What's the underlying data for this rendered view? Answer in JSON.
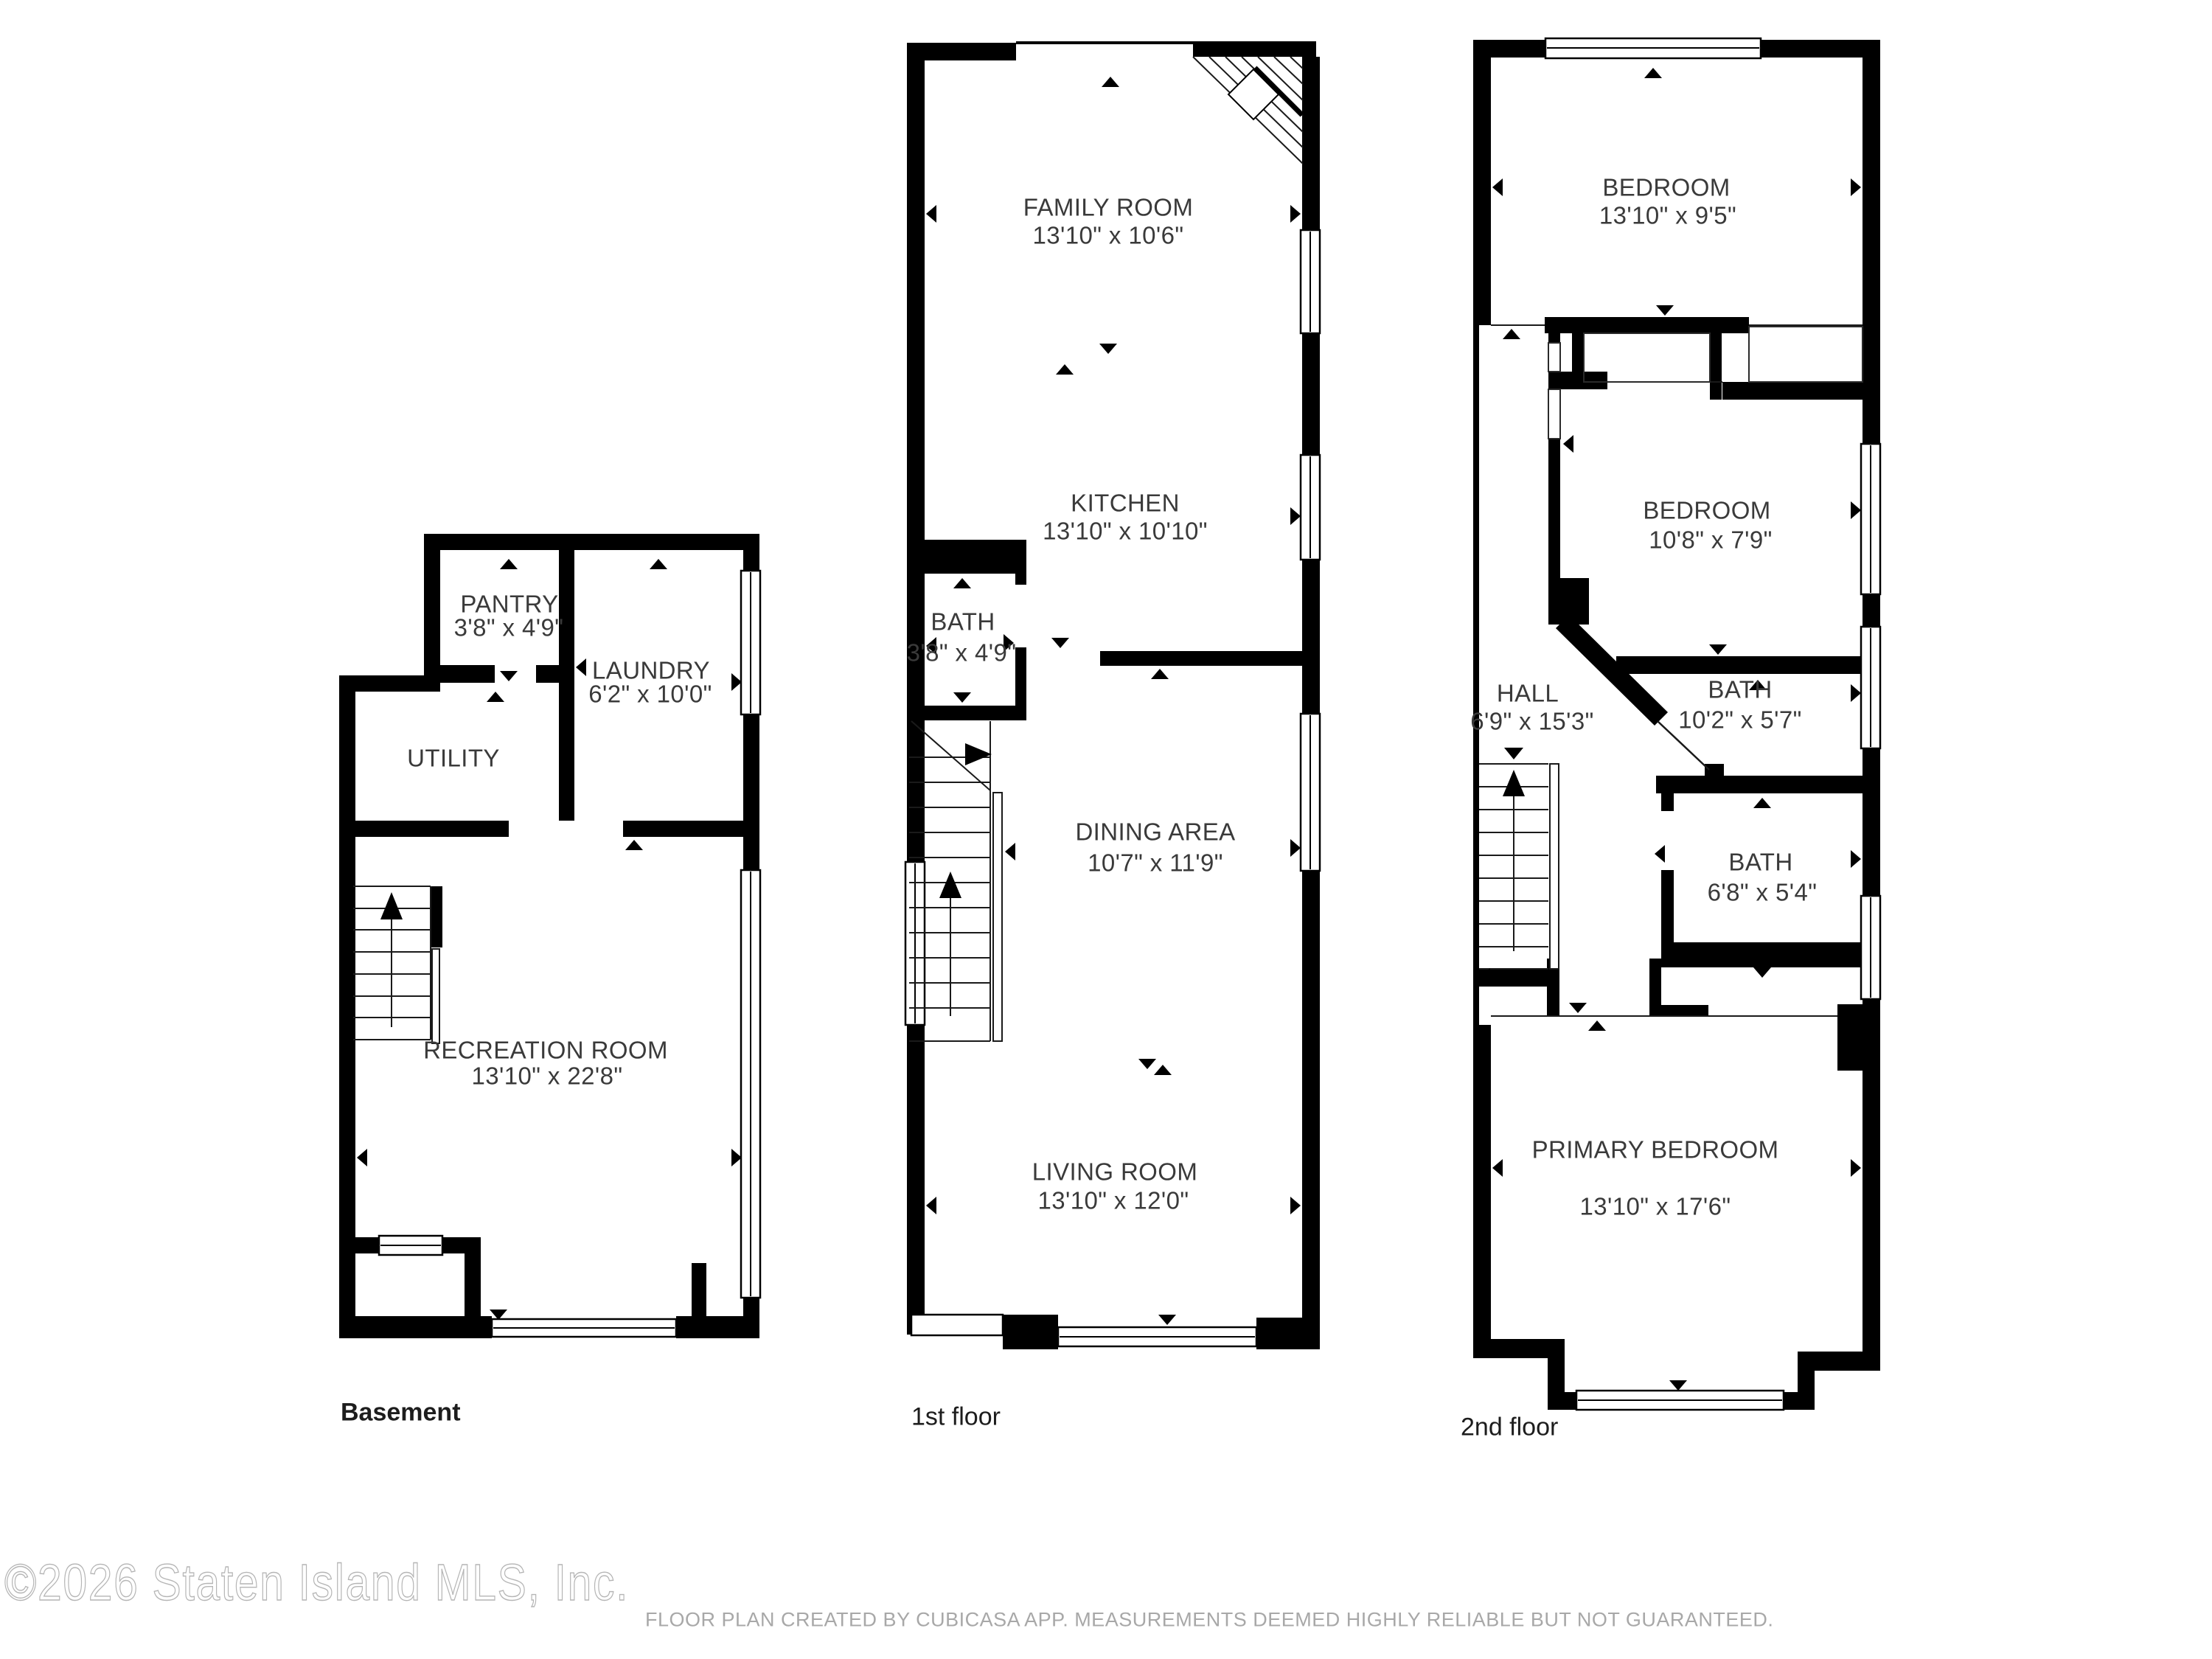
{
  "floors": [
    {
      "title": "Basement",
      "rooms": [
        {
          "name": "PANTRY",
          "dims": "3'8\" x 4'9\""
        },
        {
          "name": "LAUNDRY",
          "dims": "6'2\" x 10'0\""
        },
        {
          "name": "UTILITY",
          "dims": ""
        },
        {
          "name": "RECREATION ROOM",
          "dims": "13'10\" x 22'8\""
        }
      ]
    },
    {
      "title": "1st floor",
      "rooms": [
        {
          "name": "FAMILY ROOM",
          "dims": "13'10\" x 10'6\""
        },
        {
          "name": "KITCHEN",
          "dims": "13'10\" x 10'10\""
        },
        {
          "name": "BATH",
          "dims": "3'8\" x 4'9\""
        },
        {
          "name": "DINING AREA",
          "dims": "10'7\" x 11'9\""
        },
        {
          "name": "LIVING ROOM",
          "dims": "13'10\" x 12'0\""
        }
      ]
    },
    {
      "title": "2nd floor",
      "rooms": [
        {
          "name": "BEDROOM",
          "dims": "13'10\" x 9'5\""
        },
        {
          "name": "BEDROOM",
          "dims": "10'8\" x 7'9\""
        },
        {
          "name": "HALL",
          "dims": "6'9\" x 15'3\""
        },
        {
          "name": "BATH",
          "dims": "10'2\" x 5'7\""
        },
        {
          "name": "BATH",
          "dims": "6'8\" x 5'4\""
        },
        {
          "name": "PRIMARY BEDROOM",
          "dims": "13'10\" x 17'6\""
        }
      ]
    }
  ],
  "footer": {
    "watermark": "©2026 Staten Island MLS, Inc.",
    "disclaimer": "FLOOR PLAN CREATED BY CUBICASA APP. MEASUREMENTS DEEMED HIGHLY RELIABLE BUT NOT GUARANTEED."
  }
}
